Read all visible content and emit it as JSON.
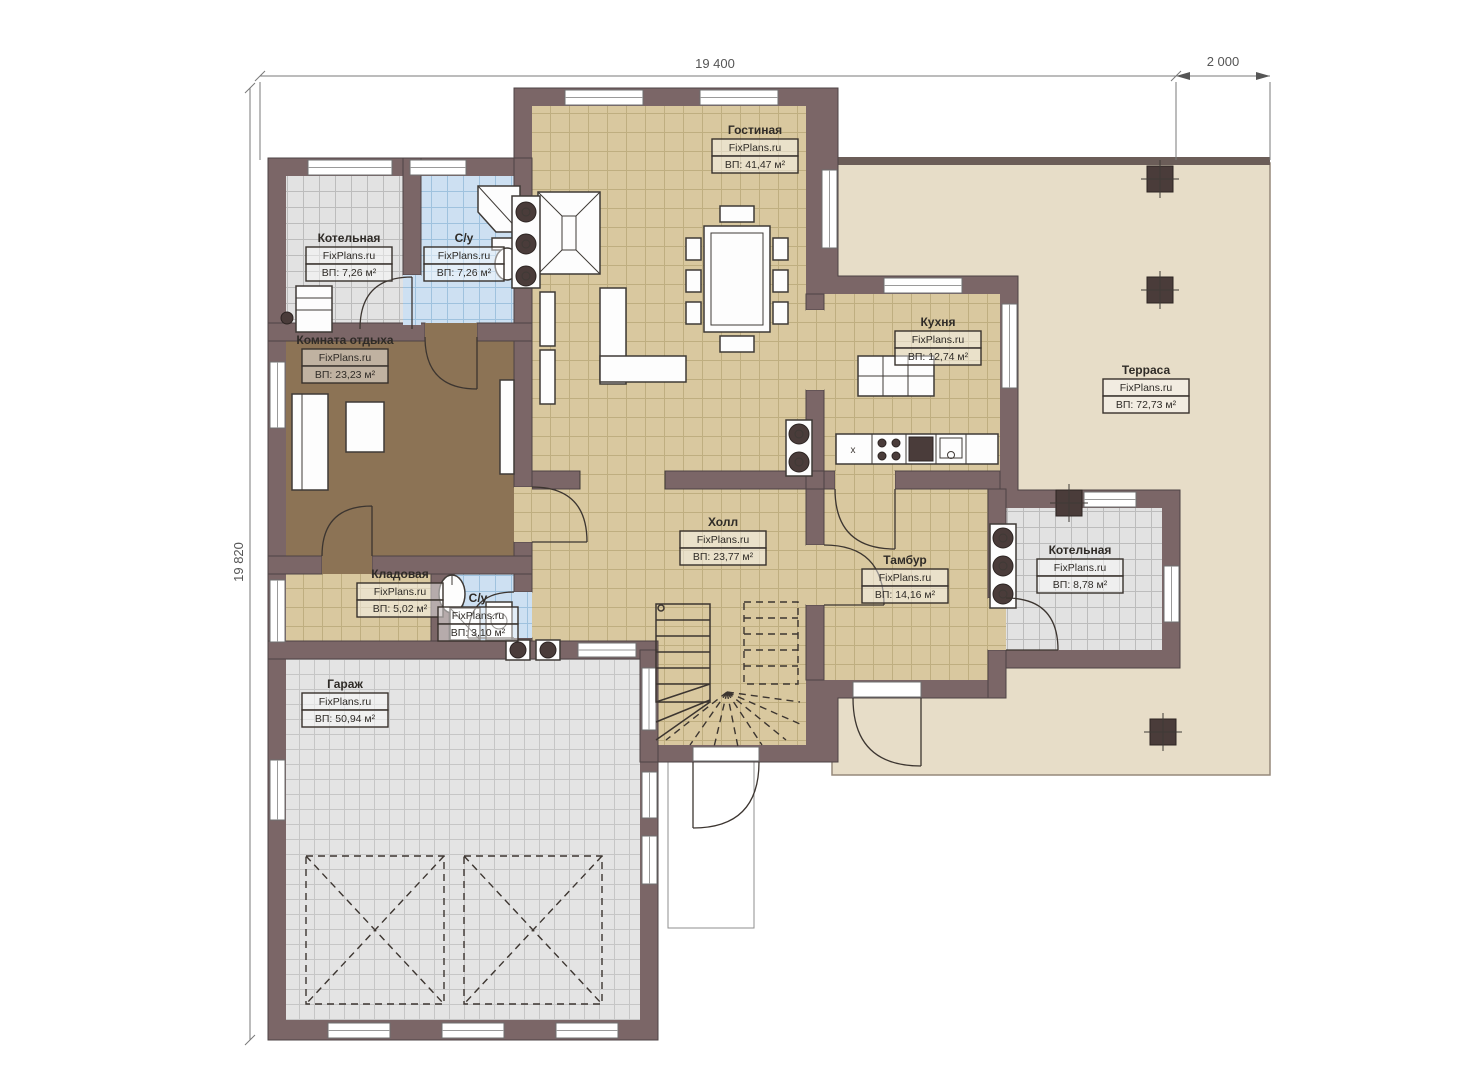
{
  "meta": {
    "brand": "FixPlans.ru",
    "drawing": "first-floor-plan"
  },
  "dimensions": {
    "top_width": "19 400",
    "top_right_width": "2 000",
    "left_height": "19 820"
  },
  "rooms": [
    {
      "id": "living",
      "name": "Гостиная",
      "area": "ВП: 41,47 м²"
    },
    {
      "id": "boiler-top",
      "name": "Котельная",
      "area": "ВП: 7,26 м²"
    },
    {
      "id": "bath-top",
      "name": "С/у",
      "area": "ВП: 7,26 м²"
    },
    {
      "id": "lounge",
      "name": "Комната отдыха",
      "area": "ВП: 23,23 м²"
    },
    {
      "id": "kitchen",
      "name": "Кухня",
      "area": "ВП: 12,74 м²"
    },
    {
      "id": "terrace",
      "name": "Терраса",
      "area": "ВП: 72,73 м²"
    },
    {
      "id": "hall",
      "name": "Холл",
      "area": "ВП: 23,77 м²"
    },
    {
      "id": "vestibule",
      "name": "Тамбур",
      "area": "ВП: 14,16 м²"
    },
    {
      "id": "boiler-right",
      "name": "Котельная",
      "area": "ВП: 8,78 м²"
    },
    {
      "id": "storage",
      "name": "Кладовая",
      "area": "ВП: 5,02 м²"
    },
    {
      "id": "bath-small",
      "name": "С/у",
      "area": "ВП: 3,10 м²"
    },
    {
      "id": "garage",
      "name": "Гараж",
      "area": "ВП: 50,94 м²"
    }
  ],
  "marks": {
    "kitchen_cabinet": "x"
  },
  "colors": {
    "wall": "#7b6667",
    "wallEdge": "#4e4344",
    "tanBg": "#d9c89f",
    "tanLine": "#bfae80",
    "blueBg": "#cde0f2",
    "blueLine": "#9fc2de",
    "greyBg": "#e2e2e2",
    "greyLine": "#bcbcbc",
    "garBg": "#e4e4e4",
    "garLine": "#c6c6c6",
    "wood": "#8c7355",
    "terrace": "#e7ddc8",
    "terraceEdge": "#95897a",
    "dim": "#7a7a7a",
    "ink": "#2f2b27"
  }
}
